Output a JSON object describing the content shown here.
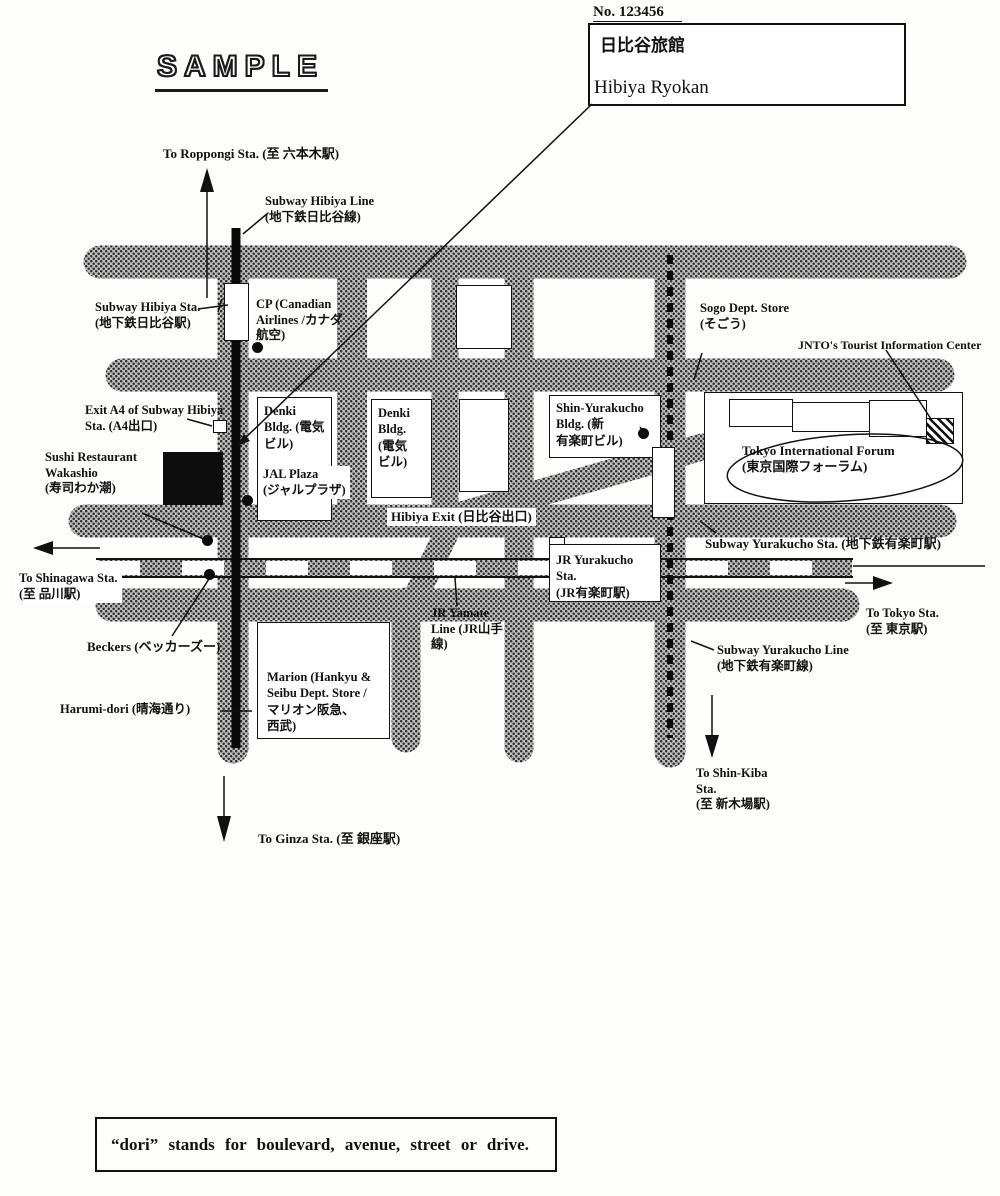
{
  "header": {
    "doc_number": "No. 123456",
    "hotel_name_ja": "日比谷旅館",
    "hotel_name_en": "Hibiya Ryokan",
    "watermark": "SAMPLE"
  },
  "map": {
    "directions": {
      "roppongi": "To Roppongi Sta. (至 六本木駅)",
      "shinagawa": "To Shinagawa Sta.\n(至 品川駅)",
      "tokyo": "To Tokyo Sta.\n(至 東京駅)",
      "shin_kiba": "To Shin-Kiba\nSta.\n(至 新木場駅)",
      "ginza": "To Ginza Sta. (至 銀座駅)"
    },
    "lines": {
      "hibiya_line": "Subway Hibiya Line\n(地下鉄日比谷線)",
      "yamate_line": "JR Yamate\nLine (JR山手\n線)",
      "yurakucho_line": "Subway Yurakucho Line\n(地下鉄有楽町線)"
    },
    "stations": {
      "hibiya_sta": "Subway Hibiya Sta.\n(地下鉄日比谷駅)",
      "jr_yurakucho_sta": "JR Yurakucho Sta.\n(JR有楽町駅)",
      "yurakucho_sta": "Subway Yurakucho Sta. (地下鉄有楽町駅)"
    },
    "places": {
      "cp": "CP (Canadian\nAirlines /カナダ\n航空)",
      "sogo": "Sogo Dept. Store\n(そごう)",
      "jnto": "JNTO's Tourist Information Center",
      "exit_a4": "Exit A4 of Subway Hibiya\nSta. (A4出口)",
      "denki_1": "Denki\nBldg. (電気\nビル)",
      "denki_2": "Denki\nBldg.\n(電気\nビル)",
      "jal_plaza": "JAL Plaza\n(ジャルプラザ)",
      "shin_yurakucho": "Shin-Yurakucho\nBldg. (新\n有楽町ビル)",
      "forum": "Tokyo International Forum\n(東京国際フォーラム)",
      "wakashio": "Sushi Restaurant\nWakashio\n(寿司わか潮)",
      "hibiya_exit": "Hibiya Exit (日比谷出口)",
      "beckers": "Beckers (ベッカーズー)",
      "marion": "Marion (Hankyu &\nSeibu Dept. Store /\nマリオン阪急、\n西武)",
      "harumi_dori": "Harumi-dori (晴海通り)"
    }
  },
  "footer": {
    "note": "“dori” stands for boulevard, avenue, street or drive."
  }
}
